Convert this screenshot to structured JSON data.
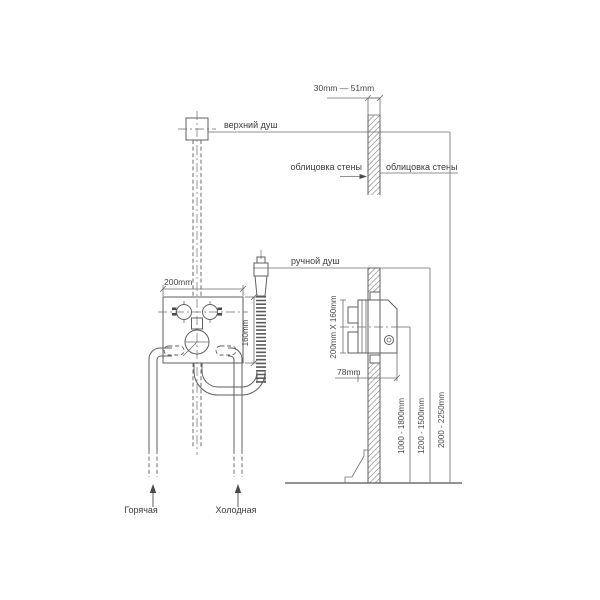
{
  "drawing": {
    "title": "shower-installation-diagram",
    "labels": {
      "top_shower": "верхний душ",
      "hand_shower": "ручной душ",
      "wall_cladding_left": "облицовка стены",
      "wall_cladding_right": "облицовка стены",
      "hot_supply": "Горячая",
      "cold_supply": "Холодная"
    },
    "dimensions": {
      "tile_thickness": "30mm — 51mm",
      "box_width": "200mm",
      "box_height": "160mm",
      "box_face": "200mm X 160mm",
      "box_depth": "78mm",
      "mixer_height_range": "1000 - 1800mm",
      "hand_shower_height_range": "1200 - 1500mm",
      "top_shower_height_range": "2000 - 2250mm"
    },
    "colors": {
      "background": "#ffffff",
      "line": "#5f5f5f",
      "hatch": "#8e8e8e",
      "text": "#3c3c3c"
    }
  }
}
